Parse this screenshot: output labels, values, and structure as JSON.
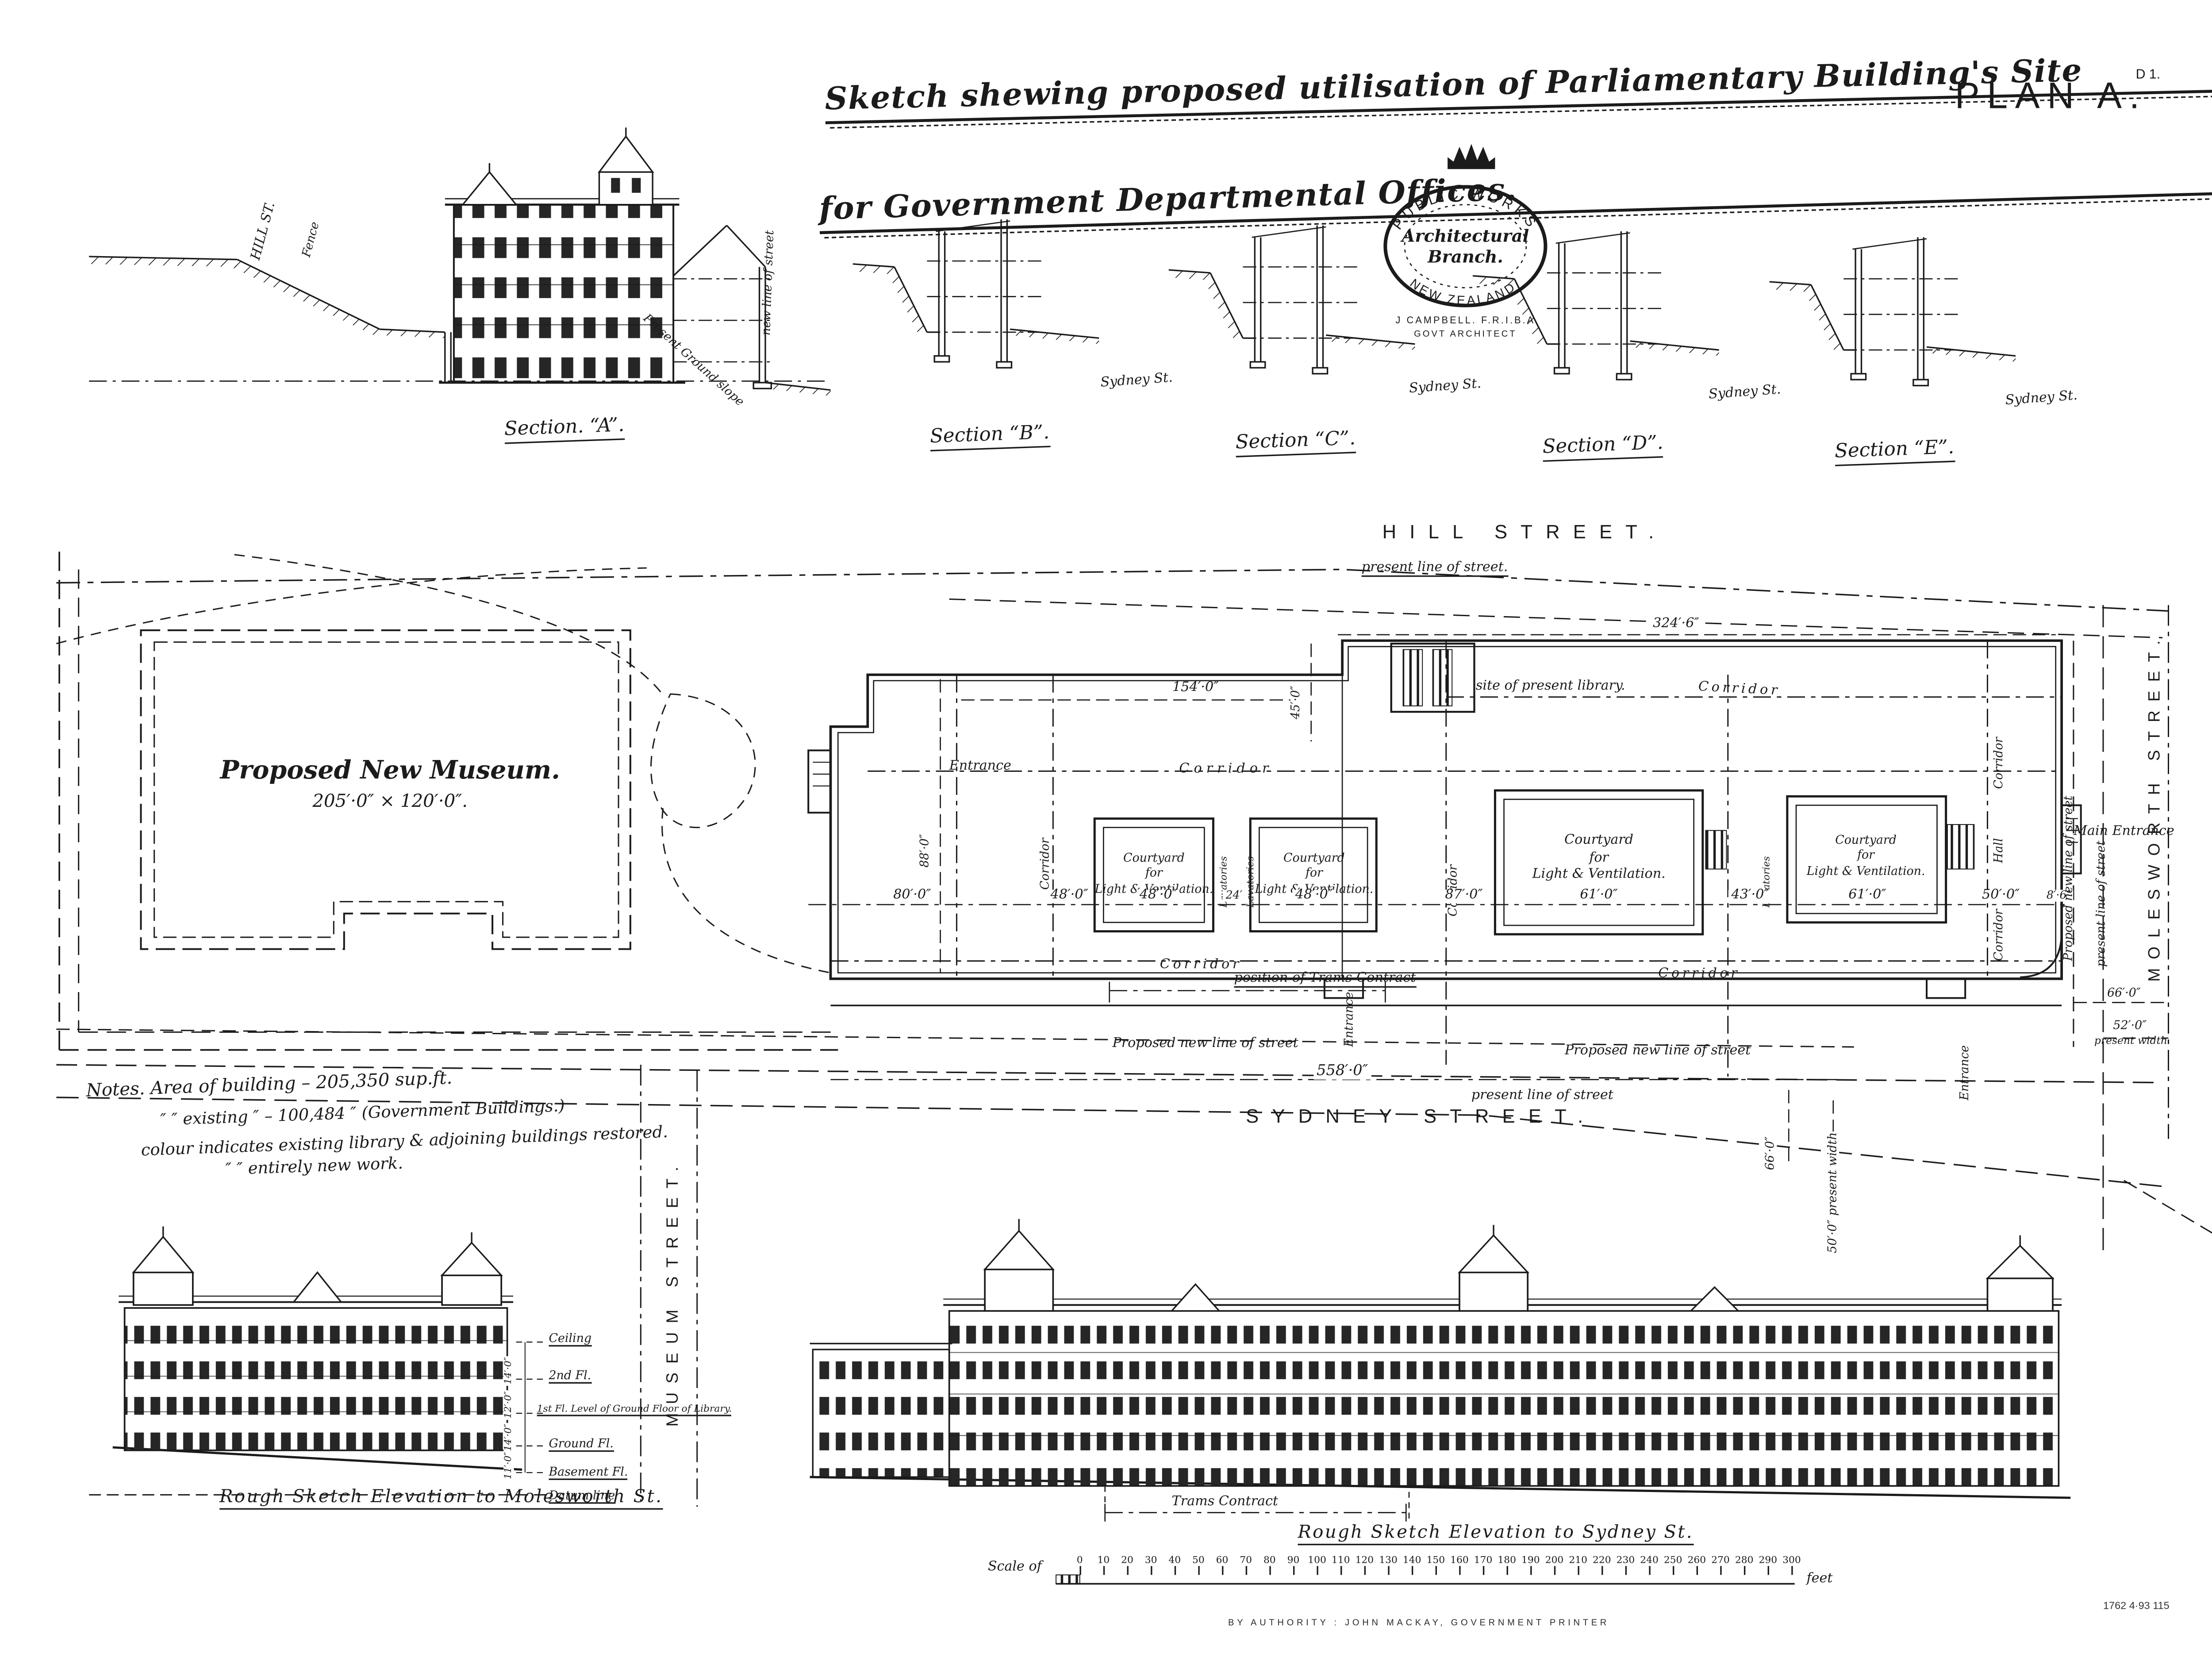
{
  "header": {
    "title_line1": "Sketch shewing proposed utilisation of Parliamentary Building's Site",
    "title_line2": "for Government Departmental Offices.",
    "plan_label": "PLAN A.",
    "corner_ref": "D 1."
  },
  "stamp": {
    "arc_top": "PUBLIC WORKS",
    "arc_bottom": "NEW ZEALAND.",
    "branch_line1": "Architectural",
    "branch_line2": "Branch.",
    "architect": "J CAMPBELL. F.R.I.B.A",
    "architect_title": "GOVT ARCHITECT"
  },
  "sections": {
    "a_label": "Section. “A”.",
    "b_label": "Section “B”.",
    "c_label": "Section “C”.",
    "d_label": "Section “D”.",
    "e_label": "Section “E”.",
    "sydney_st": "Sydney St.",
    "hill_st": "HILL ST.",
    "fence": "Fence",
    "present_ground_slope": "Present Ground slope",
    "new_line_of_street": "new line of street"
  },
  "plan": {
    "hill_street": "HILL STREET.",
    "sydney_street": "SYDNEY STREET.",
    "molesworth_street": "MOLESWORTH STREET.",
    "museum_street": "MUSEUM STREET.",
    "museum_name": "Proposed New Museum.",
    "museum_size": "205′·0″ × 120′·0″.",
    "labels": {
      "present_line_dot": "present line of street.",
      "present_line": "present line of street",
      "proposed_new_line": "Proposed new line of street",
      "corridor": "Corridor",
      "courtyard_l1": "Courtyard",
      "courtyard_l2": "for",
      "courtyard_l3": "Light & Ventilation.",
      "lavatories": "Lavatories",
      "entrance": "Entrance",
      "main_entrance": "Main Entrance",
      "hall": "Hall",
      "site_of_library": "site of present library.",
      "trams": "position of Trams Contract"
    },
    "dims": {
      "d324": "324′·6″",
      "d154": "154′·0″",
      "d45": "45′·0″",
      "d88": "88′·0″",
      "d80": "80′·0″",
      "d48": "48′·0″",
      "d24": "24′",
      "d87": "87′·0″",
      "d61": "61′·0″",
      "d43": "43′·0″",
      "d50": "50′·0″",
      "d8_6": "8′·6″",
      "d558": "558′·0″",
      "d66": "66′·0″",
      "d52": "52′·0″",
      "present_width": "present width",
      "sydney_present": "50′·0″ present width"
    }
  },
  "notes": {
    "line1": "Notes. Area of building – 205,350 sup.ft.",
    "line2": "″   ″ existing ″ – 100,484   ″   (Government Buildings.)",
    "line3": "colour indicates existing library & adjoining buildings restored.",
    "line4": "″        ″        entirely new work."
  },
  "elev_molesworth": {
    "caption": "Rough Sketch Elevation to Molesworth St.",
    "floor_ceiling": "Ceiling",
    "floor_2nd": "2nd Fl.",
    "floor_1st": "1st Fl. Level of Ground Floor of Library.",
    "floor_ground": "Ground Fl.",
    "floor_basement": "Basement Fl.",
    "datum": "Datum line",
    "dim1": "14′·0″",
    "dim2": "12′·0″",
    "dim3": "14′·0″",
    "dim4": "11′·0″"
  },
  "elev_sydney": {
    "caption": "Rough Sketch Elevation to Sydney St.",
    "trams": "Trams Contract"
  },
  "scale_bar": {
    "prefix": "Scale of",
    "suffix": "feet",
    "ticks": [
      0,
      10,
      20,
      30,
      40,
      50,
      60,
      70,
      80,
      90,
      100,
      110,
      120,
      130,
      140,
      150,
      160,
      170,
      180,
      190,
      200,
      210,
      220,
      230,
      240,
      250,
      260,
      270,
      280,
      290,
      300
    ]
  },
  "imprint": {
    "printer": "BY AUTHORITY : JOHN MACKAY, GOVERNMENT PRINTER",
    "ref": "1762   4·93   115"
  }
}
